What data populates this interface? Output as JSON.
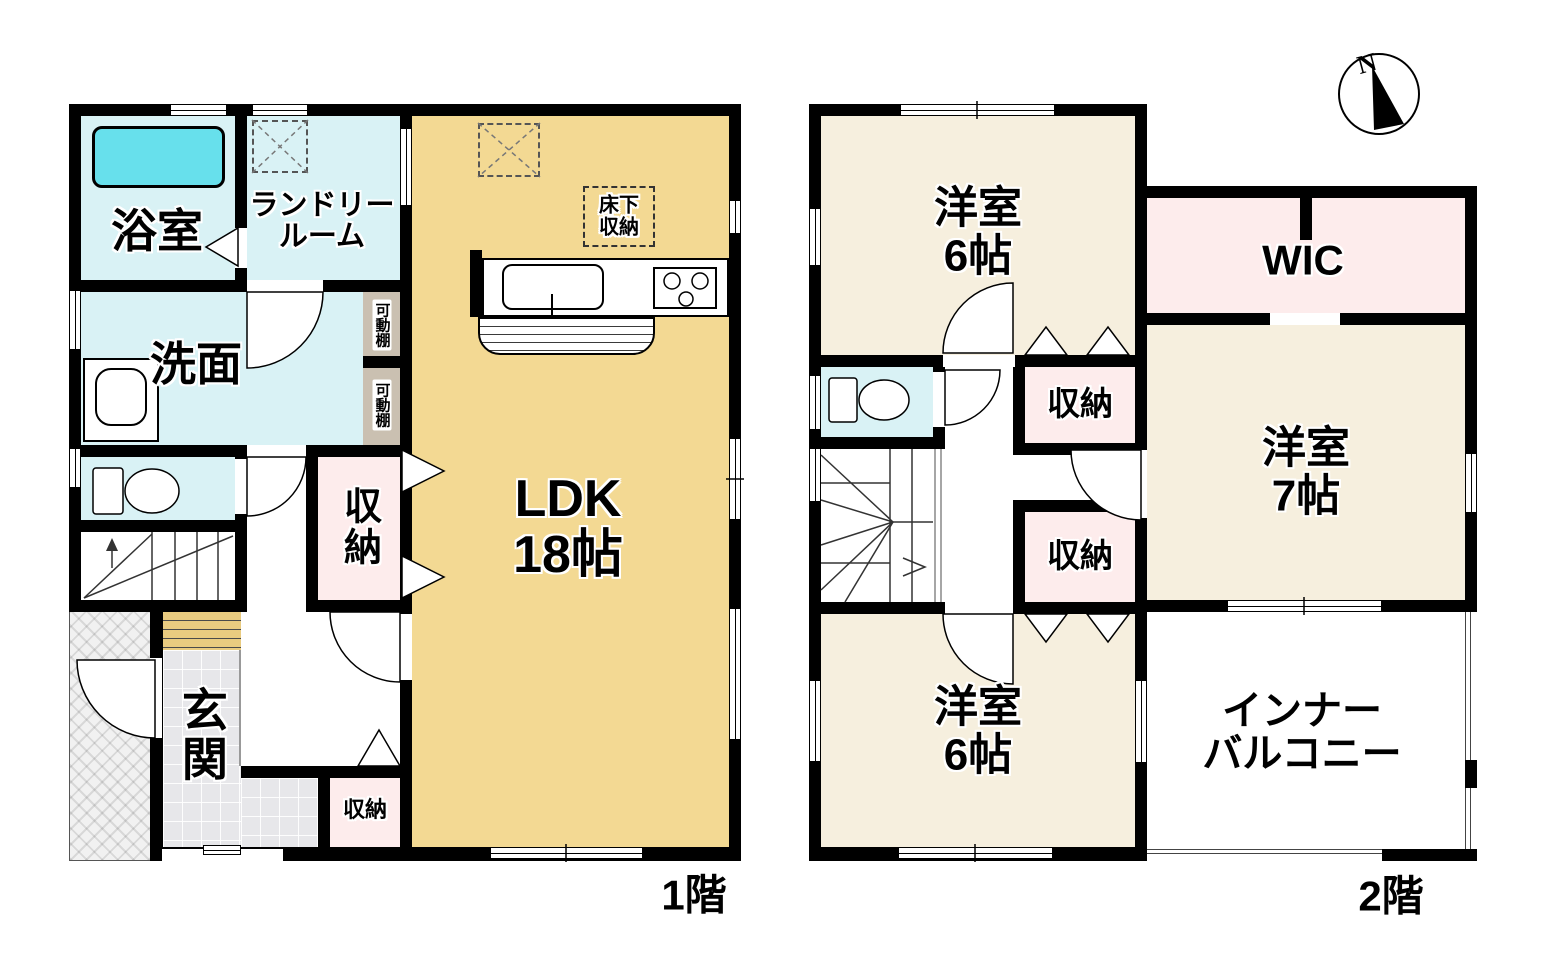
{
  "floor1": {
    "name": "1階",
    "bath": "浴室",
    "laundry_line1": "ランドリー",
    "laundry_line2": "ルーム",
    "washroom": "洗面",
    "shelf": "可動棚",
    "storage_mid": "収納",
    "ldk_line1": "LDK",
    "ldk_line2": "18帖",
    "underfloor_line1": "床下",
    "underfloor_line2": "収納",
    "entrance": "玄関",
    "storage_bottom": "収納"
  },
  "floor2": {
    "name": "2階",
    "bedroom_north_line1": "洋室",
    "bedroom_north_line2": "6帖",
    "wic": "WIC",
    "bedroom_east_line1": "洋室",
    "bedroom_east_line2": "7帖",
    "storage_north": "収納",
    "storage_south": "収納",
    "bedroom_south_line1": "洋室",
    "bedroom_south_line2": "6帖",
    "balcony_line1": "インナー",
    "balcony_line2": "バルコニー"
  },
  "compass": {
    "north": "N"
  },
  "colors": {
    "wall": "#000000",
    "ldk_floor": "#f3d993",
    "bedroom_floor": "#f6efde",
    "storage_pink": "#fdecec",
    "water_room_cyan": "#d9f2f5",
    "bathtub_cyan": "#67e0ec",
    "shelf_tan": "#cac0b1",
    "tile_gray": "#e7e7ea",
    "step_tan": "#e9cb80"
  }
}
